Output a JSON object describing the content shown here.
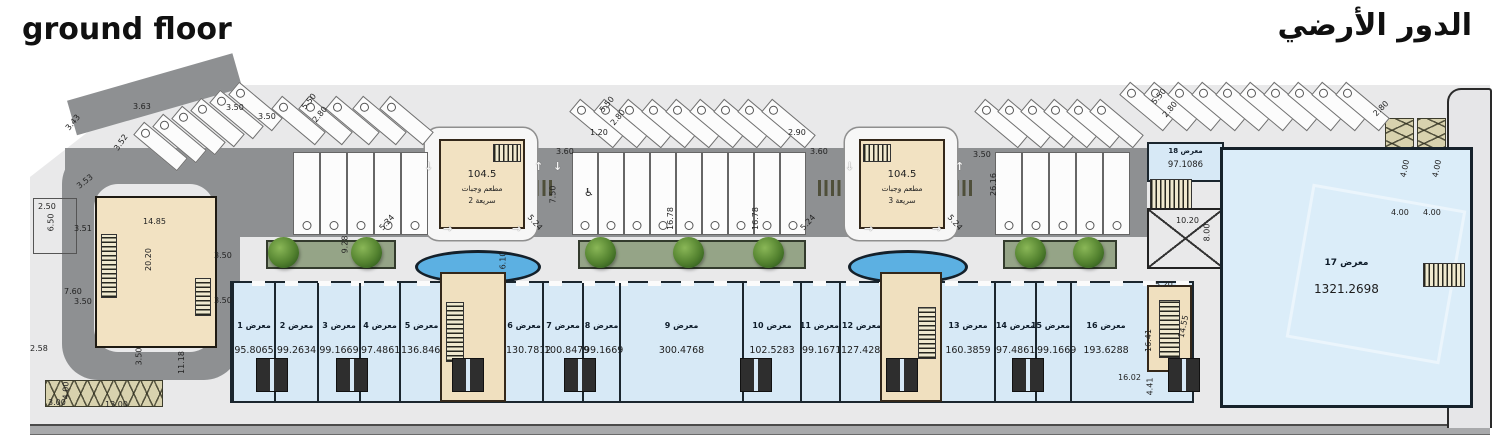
{
  "titles": {
    "en": "ground floor",
    "ar": "الدور الأرضي"
  },
  "restaurants": [
    {
      "area": "104.5",
      "line1": "مطعم وجبات",
      "line2": "سريعة 2"
    },
    {
      "area": "104.5",
      "line1": "مطعم وجبات",
      "line2": "سريعة 3"
    }
  ],
  "unit17": {
    "label": "معرض 17",
    "area": "1321.2698"
  },
  "unit18": {
    "label": "معرض 18",
    "area": "97.1086"
  },
  "shops": [
    {
      "label": "معرض 1",
      "area": "95.8065",
      "x": 230,
      "w": 42
    },
    {
      "label": "معرض 2",
      "area": "99.2634",
      "x": 272,
      "w": 43
    },
    {
      "label": "معرض 3",
      "area": "99.1669",
      "x": 315,
      "w": 42
    },
    {
      "label": "معرض 4",
      "area": "97.4861",
      "x": 357,
      "w": 40
    },
    {
      "label": "معرض 5",
      "area": "136.8465",
      "x": 397,
      "w": 43
    },
    {
      "label": "معرض 6",
      "area": "130.7812",
      "x": 502,
      "w": 38
    },
    {
      "label": "معرض 7",
      "area": "100.8479",
      "x": 540,
      "w": 40
    },
    {
      "label": "معرض 8",
      "area": "99.1669",
      "x": 580,
      "w": 37
    },
    {
      "label": "معرض 9",
      "area": "300.4768",
      "x": 617,
      "w": 123
    },
    {
      "label": "معرض 10",
      "area": "102.5283",
      "x": 740,
      "w": 58
    },
    {
      "label": "معرض 11",
      "area": "99.1671",
      "x": 798,
      "w": 39
    },
    {
      "label": "معرض 12",
      "area": "127.4287",
      "x": 837,
      "w": 43
    },
    {
      "label": "معرض 13",
      "area": "160.3859",
      "x": 938,
      "w": 54
    },
    {
      "label": "معرض 14",
      "area": "97.4861",
      "x": 992,
      "w": 41
    },
    {
      "label": "معرض 15",
      "area": "99.1669",
      "x": 1033,
      "w": 35
    },
    {
      "label": "معرض 16",
      "area": "193.6288",
      "x": 1068,
      "w": 70
    }
  ],
  "plan": {
    "dim_labels": [
      {
        "t": "3.63",
        "x": 133,
        "y": 102
      },
      {
        "t": "3.50",
        "x": 226,
        "y": 103
      },
      {
        "t": "3.43",
        "x": 64,
        "y": 118,
        "r": -50
      },
      {
        "t": "3.52",
        "x": 112,
        "y": 138,
        "r": -55
      },
      {
        "t": "3.53",
        "x": 76,
        "y": 177,
        "r": -38
      },
      {
        "t": "2.50",
        "x": 38,
        "y": 202
      },
      {
        "t": "6.50",
        "x": 42,
        "y": 218,
        "r": -90
      },
      {
        "t": "3.51",
        "x": 74,
        "y": 224
      },
      {
        "t": "14.85",
        "x": 143,
        "y": 217
      },
      {
        "t": "20.20",
        "x": 137,
        "y": 255,
        "r": -90
      },
      {
        "t": "3.50",
        "x": 214,
        "y": 251
      },
      {
        "t": "3.50",
        "x": 214,
        "y": 296
      },
      {
        "t": "7.60",
        "x": 64,
        "y": 287
      },
      {
        "t": "3.50",
        "x": 74,
        "y": 297
      },
      {
        "t": "2.58",
        "x": 30,
        "y": 344
      },
      {
        "t": "3.50",
        "x": 130,
        "y": 352,
        "r": -90
      },
      {
        "t": "11.18",
        "x": 170,
        "y": 358,
        "r": -90
      },
      {
        "t": "3.00",
        "x": 48,
        "y": 398
      },
      {
        "t": "4.00",
        "x": 57,
        "y": 386,
        "r": -90
      },
      {
        "t": "13.00",
        "x": 105,
        "y": 400
      },
      {
        "t": "3.50",
        "x": 258,
        "y": 112
      },
      {
        "t": "5.50",
        "x": 300,
        "y": 97,
        "r": -50
      },
      {
        "t": "2.80",
        "x": 311,
        "y": 110,
        "r": -50
      },
      {
        "t": "1.20",
        "x": 590,
        "y": 128
      },
      {
        "t": "2.90",
        "x": 788,
        "y": 128
      },
      {
        "t": "3.60",
        "x": 556,
        "y": 147
      },
      {
        "t": "3.60",
        "x": 810,
        "y": 147
      },
      {
        "t": "5.50",
        "x": 598,
        "y": 100,
        "r": -50
      },
      {
        "t": "2.80",
        "x": 609,
        "y": 113,
        "r": -50
      },
      {
        "t": "7.50",
        "x": 544,
        "y": 190,
        "r": -90
      },
      {
        "t": "5.24",
        "x": 378,
        "y": 218,
        "r": -48
      },
      {
        "t": "5.24",
        "x": 526,
        "y": 218,
        "r": 48
      },
      {
        "t": "5.24",
        "x": 799,
        "y": 218,
        "r": -48
      },
      {
        "t": "5.24",
        "x": 946,
        "y": 218,
        "r": 48
      },
      {
        "t": "3.50",
        "x": 973,
        "y": 150
      },
      {
        "t": "26.16",
        "x": 982,
        "y": 180,
        "r": -90
      },
      {
        "t": "16.78",
        "x": 659,
        "y": 214,
        "r": -90
      },
      {
        "t": "16.78",
        "x": 744,
        "y": 214,
        "r": -90
      },
      {
        "t": "9.28",
        "x": 336,
        "y": 240,
        "r": -90
      },
      {
        "t": "6.10",
        "x": 494,
        "y": 256,
        "r": -90
      },
      {
        "t": "5.50",
        "x": 1150,
        "y": 92,
        "r": -50
      },
      {
        "t": "2.80",
        "x": 1161,
        "y": 105,
        "r": -50
      },
      {
        "t": "10.20",
        "x": 1176,
        "y": 216
      },
      {
        "t": "8.00",
        "x": 1198,
        "y": 228,
        "r": -90
      },
      {
        "t": "5.20",
        "x": 1155,
        "y": 280
      },
      {
        "t": "14.55",
        "x": 1172,
        "y": 322,
        "r": -78
      },
      {
        "t": "16.41",
        "x": 1137,
        "y": 336,
        "r": -90
      },
      {
        "t": "16.02",
        "x": 1118,
        "y": 373
      },
      {
        "t": "4.41",
        "x": 1141,
        "y": 382,
        "r": -90
      },
      {
        "t": "4.00",
        "x": 1391,
        "y": 208
      },
      {
        "t": "4.00",
        "x": 1423,
        "y": 208
      },
      {
        "t": "4.00",
        "x": 1396,
        "y": 164,
        "r": -78
      },
      {
        "t": "4.00",
        "x": 1428,
        "y": 164,
        "r": -78
      },
      {
        "t": "2.80",
        "x": 1372,
        "y": 104,
        "r": -45
      }
    ],
    "parking": {
      "stall_depth": "5.50",
      "stall_width": "2.80",
      "angled_groups": [
        {
          "x": 152,
          "y": 118,
          "count": 6,
          "step": 19,
          "rise": 8
        },
        {
          "x": 290,
          "y": 92,
          "count": 5,
          "step": 27,
          "rise": 0
        },
        {
          "x": 588,
          "y": 95,
          "count": 9,
          "step": 24,
          "rise": 0
        },
        {
          "x": 993,
          "y": 95,
          "count": 6,
          "step": 23,
          "rise": 0
        },
        {
          "x": 1138,
          "y": 78,
          "count": 10,
          "step": 24,
          "rise": 0
        }
      ],
      "straight_groups": [
        {
          "x": 293,
          "y": 152,
          "count": 5,
          "w": 27
        },
        {
          "x": 572,
          "y": 152,
          "count": 9,
          "w": 26
        },
        {
          "x": 995,
          "y": 152,
          "count": 5,
          "w": 27
        }
      ]
    },
    "planters": [
      {
        "x": 266,
        "w": 126
      },
      {
        "x": 578,
        "w": 224
      },
      {
        "x": 1003,
        "w": 110
      }
    ],
    "trees": [
      283,
      366,
      600,
      688,
      768,
      1030,
      1088
    ],
    "ponds": [
      {
        "x": 415,
        "w": 120
      },
      {
        "x": 848,
        "w": 114
      }
    ],
    "wc_blocks": [
      256,
      336,
      564,
      740,
      1012,
      1168,
      452,
      886
    ],
    "arrows": [
      {
        "x": 424,
        "y": 160,
        "g": "↓"
      },
      {
        "x": 534,
        "y": 160,
        "g": "↑"
      },
      {
        "x": 553,
        "y": 160,
        "g": "↓"
      },
      {
        "x": 443,
        "y": 222,
        "g": "→"
      },
      {
        "x": 512,
        "y": 222,
        "g": "→"
      },
      {
        "x": 845,
        "y": 160,
        "g": "↓"
      },
      {
        "x": 955,
        "y": 160,
        "g": "↑"
      },
      {
        "x": 864,
        "y": 222,
        "g": "→"
      },
      {
        "x": 932,
        "y": 222,
        "g": "→"
      }
    ],
    "accessible": {
      "x": 584,
      "y": 186,
      "g": "♿"
    }
  }
}
